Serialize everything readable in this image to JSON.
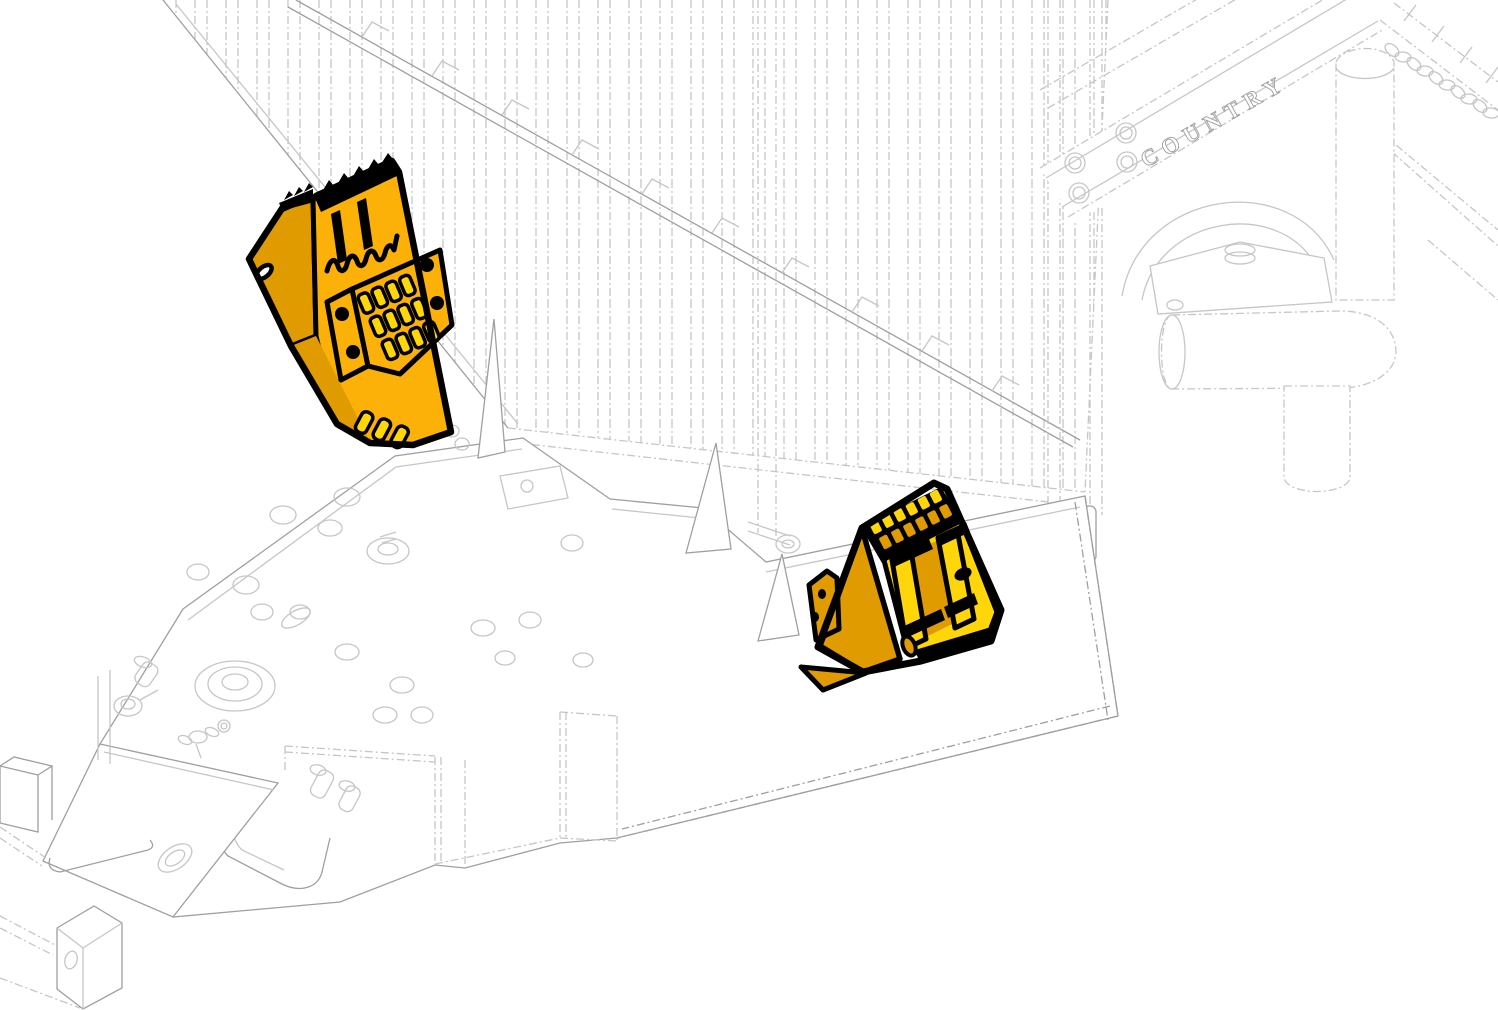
{
  "illustration": {
    "background_color": "#ffffff",
    "brand_text": "COUNTRY",
    "lineart_colors": {
      "light": "#c6c6c6",
      "mid": "#9f9f9f"
    },
    "highlight_colors": {
      "main": "#FBB108",
      "bright": "#FFD60A",
      "shade": "#E09B00",
      "outline": "#000000"
    },
    "parts": [
      {
        "name": "highlighted-component-left"
      },
      {
        "name": "highlighted-component-right"
      }
    ]
  }
}
